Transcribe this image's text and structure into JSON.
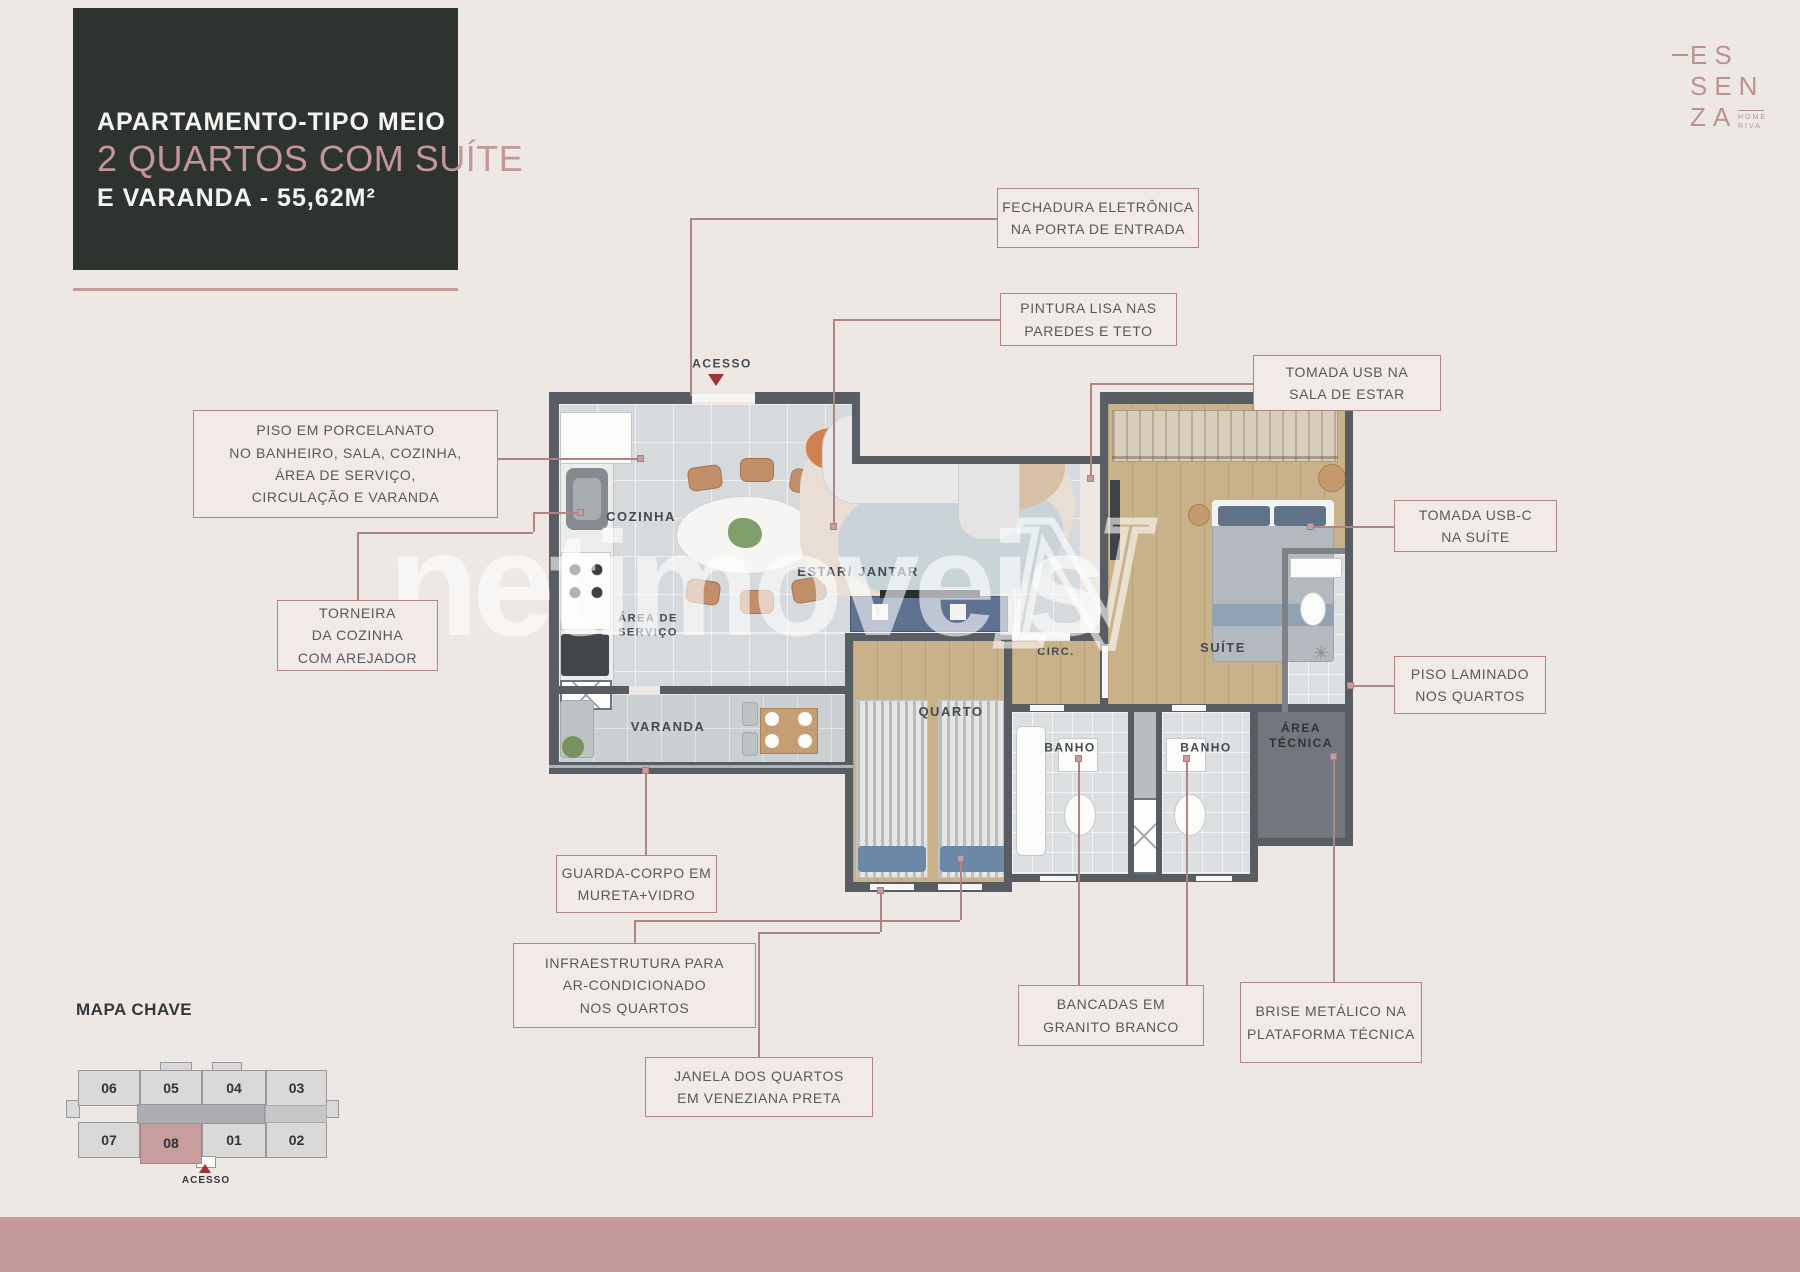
{
  "page": {
    "background": "#EDE8E4",
    "bottom_band_color": "#C59B99",
    "accent": "#B08384"
  },
  "title_card": {
    "line1": "APARTAMENTO-TIPO MEIO",
    "line2": "2 QUARTOS COM SUÍTE",
    "line3": "E VARANDA - 55,62M²",
    "bg": "#2D342F"
  },
  "logo": {
    "l1": "ES",
    "l2": "SEN",
    "l3": "ZA",
    "sub1": "HOME",
    "sub2": "RIVA"
  },
  "watermark": {
    "text": "netimoveis",
    "mark": "N"
  },
  "plan": {
    "acesso_label": "ACESSO",
    "labels": [
      {
        "id": "label-cozinha",
        "lines": [
          "COZINHA"
        ],
        "x": 641,
        "y": 517,
        "size": 13
      },
      {
        "id": "label-estar-jantar",
        "lines": [
          "ESTAR/ JANTAR"
        ],
        "x": 858,
        "y": 572,
        "size": 13
      },
      {
        "id": "label-area-servico",
        "lines": [
          "ÁREA DE",
          "SERVIÇO"
        ],
        "x": 648,
        "y": 626,
        "size": 11
      },
      {
        "id": "label-varanda",
        "lines": [
          "VARANDA"
        ],
        "x": 668,
        "y": 727,
        "size": 13
      },
      {
        "id": "label-quarto",
        "lines": [
          "QUARTO"
        ],
        "x": 951,
        "y": 712,
        "size": 13
      },
      {
        "id": "label-circ",
        "lines": [
          "CIRC."
        ],
        "x": 1056,
        "y": 653,
        "size": 11
      },
      {
        "id": "label-suite",
        "lines": [
          "SUÍTE"
        ],
        "x": 1223,
        "y": 648,
        "size": 13
      },
      {
        "id": "label-banho-1",
        "lines": [
          "BANHO"
        ],
        "x": 1070,
        "y": 748,
        "size": 12
      },
      {
        "id": "label-banho-2",
        "lines": [
          "BANHO"
        ],
        "x": 1206,
        "y": 748,
        "size": 12
      },
      {
        "id": "label-area-tecnica",
        "lines": [
          "ÁREA",
          "TÉCNICA"
        ],
        "x": 1301,
        "y": 736,
        "size": 12,
        "dark": true
      },
      {
        "id": "label-acesso",
        "lines": [
          "ACESSO"
        ],
        "x": 722,
        "y": 364,
        "size": 12
      }
    ]
  },
  "callouts": [
    {
      "id": "fechadura",
      "x": 997,
      "y": 188,
      "w": 202,
      "h": 60,
      "lines": [
        "FECHADURA ELETRÔNICA",
        "NA PORTA DE ENTRADA"
      ]
    },
    {
      "id": "pintura",
      "x": 1000,
      "y": 293,
      "w": 177,
      "h": 53,
      "lines": [
        "PINTURA LISA NAS",
        "PAREDES E TETO"
      ]
    },
    {
      "id": "tomada-usb",
      "x": 1253,
      "y": 355,
      "w": 188,
      "h": 56,
      "lines": [
        "TOMADA USB NA",
        "SALA DE ESTAR"
      ]
    },
    {
      "id": "tomada-usb-c",
      "x": 1394,
      "y": 500,
      "w": 163,
      "h": 52,
      "lines": [
        "TOMADA USB-C",
        "NA SUÍTE"
      ]
    },
    {
      "id": "piso-porcelanato",
      "x": 193,
      "y": 410,
      "w": 305,
      "h": 108,
      "lines": [
        "PISO EM PORCELANATO",
        "NO BANHEIRO, SALA, COZINHA,",
        "ÁREA DE SERVIÇO,",
        "CIRCULAÇÃO E VARANDA"
      ]
    },
    {
      "id": "torneira",
      "x": 277,
      "y": 600,
      "w": 161,
      "h": 71,
      "lines": [
        "TORNEIRA",
        "DA COZINHA",
        "COM AREJADOR"
      ]
    },
    {
      "id": "piso-laminado",
      "x": 1394,
      "y": 656,
      "w": 152,
      "h": 58,
      "lines": [
        "PISO LAMINADO",
        "NOS QUARTOS"
      ]
    },
    {
      "id": "guarda-corpo",
      "x": 556,
      "y": 855,
      "w": 161,
      "h": 58,
      "lines": [
        "GUARDA-CORPO EM",
        "MURETA+VIDRO"
      ]
    },
    {
      "id": "infraestrutura",
      "x": 513,
      "y": 943,
      "w": 243,
      "h": 85,
      "lines": [
        "INFRAESTRUTURA PARA",
        "AR-CONDICIONADO",
        "NOS QUARTOS"
      ]
    },
    {
      "id": "janela",
      "x": 645,
      "y": 1057,
      "w": 228,
      "h": 60,
      "lines": [
        "JANELA DOS QUARTOS",
        "EM VENEZIANA PRETA"
      ]
    },
    {
      "id": "bancadas",
      "x": 1018,
      "y": 985,
      "w": 186,
      "h": 61,
      "lines": [
        "BANCADAS EM",
        "GRANITO BRANCO"
      ]
    },
    {
      "id": "brise",
      "x": 1240,
      "y": 982,
      "w": 182,
      "h": 81,
      "lines": [
        "BRISE METÁLICO NA",
        "PLATAFORMA TÉCNICA"
      ]
    }
  ],
  "connectors": [
    {
      "id": "fechadura",
      "points": [
        [
          997,
          218
        ],
        [
          690,
          218
        ],
        [
          690,
          396
        ]
      ],
      "dot": false
    },
    {
      "id": "pintura",
      "points": [
        [
          1000,
          319
        ],
        [
          833,
          319
        ],
        [
          833,
          526
        ]
      ],
      "dot": true
    },
    {
      "id": "tomada-usb",
      "points": [
        [
          1253,
          383
        ],
        [
          1090,
          383
        ],
        [
          1090,
          478
        ]
      ],
      "dot": true
    },
    {
      "id": "tomada-usb-c",
      "points": [
        [
          1394,
          526
        ],
        [
          1310,
          526
        ]
      ],
      "dot": true
    },
    {
      "id": "piso-porcelanato",
      "points": [
        [
          497,
          458
        ],
        [
          640,
          458
        ]
      ],
      "dot": true
    },
    {
      "id": "torneira",
      "points": [
        [
          357,
          600
        ],
        [
          357,
          532
        ],
        [
          533,
          532
        ],
        [
          533,
          512
        ],
        [
          580,
          512
        ]
      ],
      "dot": true
    },
    {
      "id": "piso-laminado",
      "points": [
        [
          1394,
          685
        ],
        [
          1350,
          685
        ]
      ],
      "dot": true
    },
    {
      "id": "guarda-corpo",
      "points": [
        [
          645,
          855
        ],
        [
          645,
          770
        ]
      ],
      "dot": true
    },
    {
      "id": "infraestrutura",
      "points": [
        [
          634,
          943
        ],
        [
          634,
          920
        ],
        [
          960,
          920
        ],
        [
          960,
          858
        ]
      ],
      "dot": true
    },
    {
      "id": "janela",
      "points": [
        [
          758,
          1057
        ],
        [
          758,
          932
        ],
        [
          880,
          932
        ],
        [
          880,
          890
        ]
      ],
      "dot": true
    },
    {
      "id": "bancadas-1",
      "points": [
        [
          1078,
          985
        ],
        [
          1078,
          758
        ]
      ],
      "dot": true
    },
    {
      "id": "bancadas-2",
      "points": [
        [
          1186,
          985
        ],
        [
          1186,
          758
        ]
      ],
      "dot": true
    },
    {
      "id": "brise",
      "points": [
        [
          1333,
          982
        ],
        [
          1333,
          756
        ]
      ],
      "dot": true
    }
  ],
  "map": {
    "title": "MAPA CHAVE",
    "acesso_label": "ACESSO",
    "units": [
      {
        "label": "06",
        "x": 78,
        "y": 1070,
        "w": 62,
        "h": 36,
        "highlight": false
      },
      {
        "label": "05",
        "x": 140,
        "y": 1070,
        "w": 62,
        "h": 36,
        "highlight": false
      },
      {
        "label": "04",
        "x": 202,
        "y": 1070,
        "w": 64,
        "h": 36,
        "highlight": false
      },
      {
        "label": "03",
        "x": 266,
        "y": 1070,
        "w": 61,
        "h": 36,
        "highlight": false
      },
      {
        "label": "07",
        "x": 78,
        "y": 1122,
        "w": 62,
        "h": 36,
        "highlight": false
      },
      {
        "label": "08",
        "x": 140,
        "y": 1122,
        "w": 62,
        "h": 42,
        "highlight": true
      },
      {
        "label": "01",
        "x": 202,
        "y": 1122,
        "w": 64,
        "h": 36,
        "highlight": false
      },
      {
        "label": "02",
        "x": 266,
        "y": 1122,
        "w": 61,
        "h": 36,
        "highlight": false
      }
    ]
  }
}
